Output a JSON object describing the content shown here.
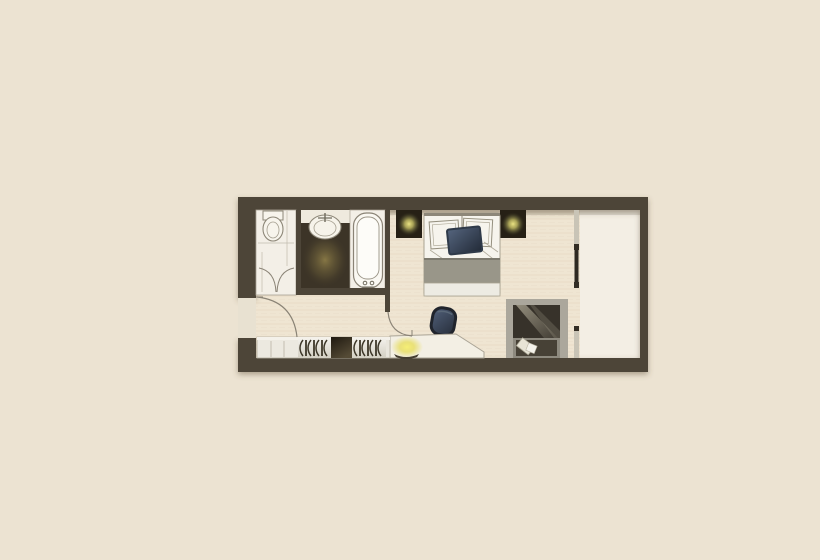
{
  "meta": {
    "type": "floor-plan",
    "view": "top-down",
    "subject": "studio hotel room with bathroom, double bed, desk, wardrobe, window seat and balcony"
  },
  "colors": {
    "background": "#ece3d2",
    "wall": "#4d4538",
    "floor": "#efe5d2",
    "floor_grain": "#d9c9ad",
    "balcony_floor": "#f3eee4",
    "entry_opening": "#e8e1d1",
    "bathroom_floor": "#f3efe7",
    "vanity_floor": "#3c3427",
    "vanity_glow": "#8a7a46",
    "counter": "#efeade",
    "fixture_white": "#f7f4ec",
    "bed_linen": "#f6f4ed",
    "bed_blanket": "#999689",
    "bed_foot": "#edebe3",
    "bed_throw_navy": "#2f3a49",
    "headboard_panel": "#262015",
    "lamp_glow": "#e6df8a",
    "chair": "#39455a",
    "desk": "#f3efe4",
    "desk_lamp_glow": "#f2ea67",
    "desk_lamp_base": "#453e30",
    "wardrobe_body": "#e9e6dd",
    "wardrobe_dark": "#241d12",
    "hanger": "#3e3829",
    "nook_frame": "#aba79c",
    "nook_interior": "#37322a",
    "nook_cushion": "#474136",
    "pillow_light": "#e8e4d6",
    "window_frame_light": "#c9c4b6",
    "window_frame_dark": "#2e2921",
    "sketch_line": "#8a8376"
  },
  "icons": [
    "toilet-icon",
    "washbasin-icon",
    "bathtub-icon",
    "shower-folding-door-icon",
    "bedside-lamp-left-icon",
    "bedside-lamp-right-icon",
    "bed-pillow-icons",
    "bed-throw-icon",
    "office-chair-icon",
    "desk-lamp-icon",
    "clothes-hanger-icons",
    "window-seat-pillow-icons",
    "entry-door-arc-icon",
    "interior-door-arc-icon"
  ]
}
